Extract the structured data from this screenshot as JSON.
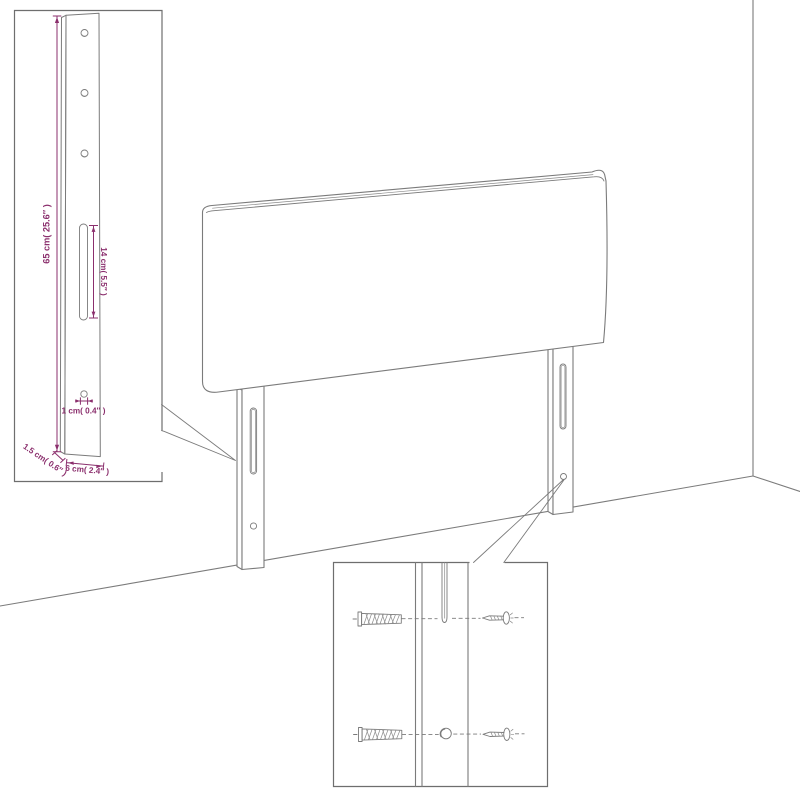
{
  "page": {
    "background": "#ffffff",
    "description": "Black-and-white line-art assembly diagram of an upholstered headboard with two mounting legs standing against a room corner, with two magnified detail insets"
  },
  "palette": {
    "line_gray": "#7b7b7b",
    "dimension_magenta": "#8b2f6d"
  },
  "main_drawing": {
    "headboard_panel": "upholstered headboard panel, perspective view",
    "left_leg": {
      "slot": "vertical adjustment slot",
      "hole": "round screw hole"
    },
    "right_leg": {
      "slot": "vertical adjustment slot",
      "hole": "round screw hole"
    },
    "wall": "room corner: vertical wall edge and floor lines"
  },
  "inset_top_left": {
    "content": "magnified side view of mounting leg: three holes at top, long slot, small hole near bottom",
    "dimensions": {
      "leg_height": "65 cm( 25.6″ )",
      "slot_length": "14 cm( 5.5″ )",
      "hole_diameter": "1 cm( 0.4″ )",
      "leg_thickness": "1.5 cm( 0.6″ )",
      "leg_width": "6 cm( 2.4″ )"
    }
  },
  "inset_bottom_right": {
    "content": "magnified front view of leg slot and hole with wall plugs and screws alignment",
    "hardware": {
      "wall_plugs": 2,
      "screws": 2
    }
  }
}
